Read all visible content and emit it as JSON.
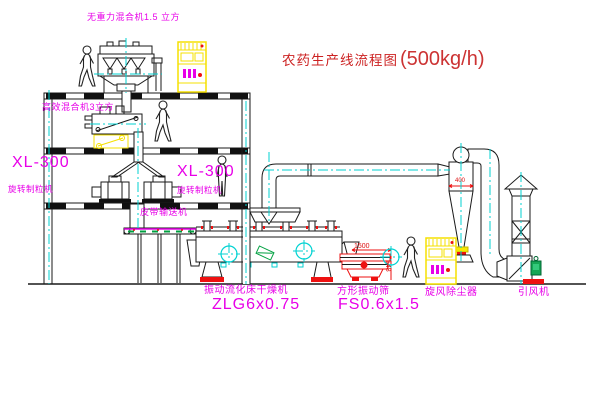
{
  "title": {
    "name": "农药生产线流程图",
    "capacity": "(500kg/h)"
  },
  "equipment_labels": {
    "gravity_free_mixer": "无重力混合机1.5 立方",
    "high_efficiency_mixer": "高效混合机3立方",
    "granulator_left_model": "XL-300",
    "granulator_left_name": "旋转制粒机",
    "granulator_right_model": "XL-300",
    "granulator_right_name": "旋转制粒机",
    "belt_conveyor": "皮带输送机",
    "fluid_bed_dryer_name": "振动流化床干燥机",
    "fluid_bed_dryer_model": "ZLG6x0.75",
    "square_vibrating_sieve_name": "方形振动筛",
    "square_vibrating_sieve_model": "FS0.6x1.5",
    "cyclone_dust_collector": "旋风除尘器",
    "induced_draft_fan": "引风机"
  },
  "dimensions": {
    "sieve_length": "1500",
    "sieve_height": "548",
    "cyclone_dia": "400"
  },
  "colors": {
    "label_magenta": "#e800e8",
    "title_red": "#cc2222",
    "dim_red": "#dd1111",
    "centerline_cyan": "#00d2d2",
    "cabinet_yellow": "#f5e000",
    "motor_green": "#15a654",
    "line_black": "#1a1a1a",
    "background": "#ffffff"
  }
}
